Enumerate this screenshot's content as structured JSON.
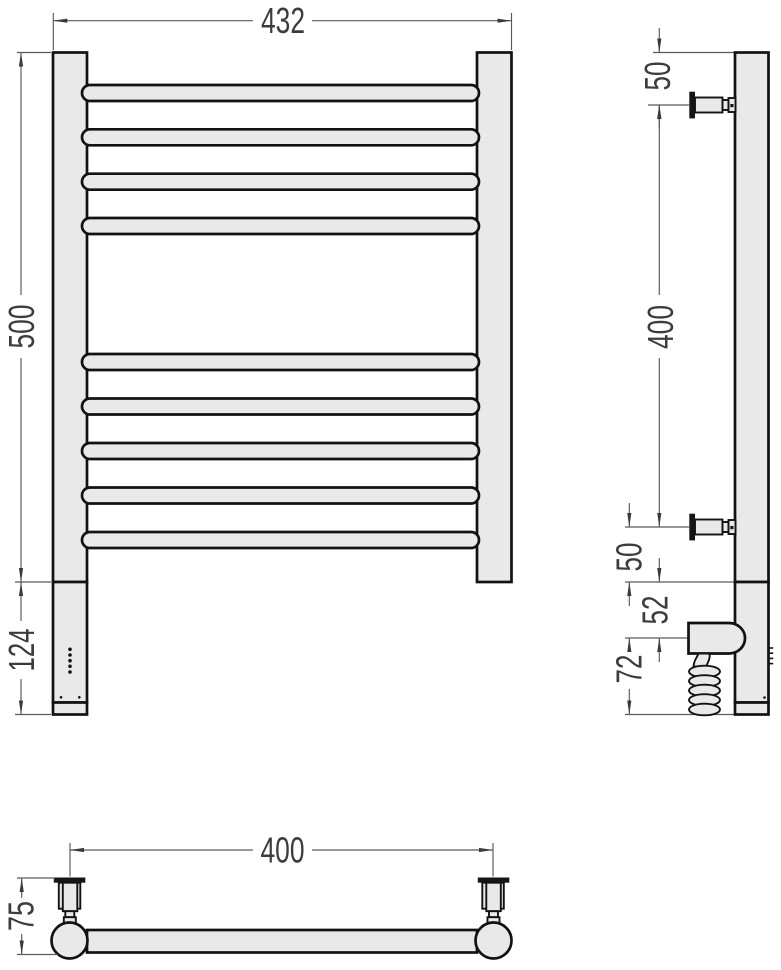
{
  "drawing": {
    "front_view": {
      "overall_width": "432",
      "rail_height": "500",
      "heater_section_height": "124"
    },
    "side_view": {
      "top_to_bracket": "50",
      "bracket_spacing": "400",
      "bracket_to_base": "50",
      "base_to_heater_axis": "52",
      "heater_axis_to_bottom": "72"
    },
    "plan_view": {
      "bracket_spacing": "400",
      "wall_to_front_depth": "75"
    },
    "colors": {
      "outline": "#121212",
      "fill": "#e9e9e9",
      "dimension_line": "#5a5a5a",
      "dimension_text": "#3c3c3c",
      "background": "#ffffff"
    }
  }
}
